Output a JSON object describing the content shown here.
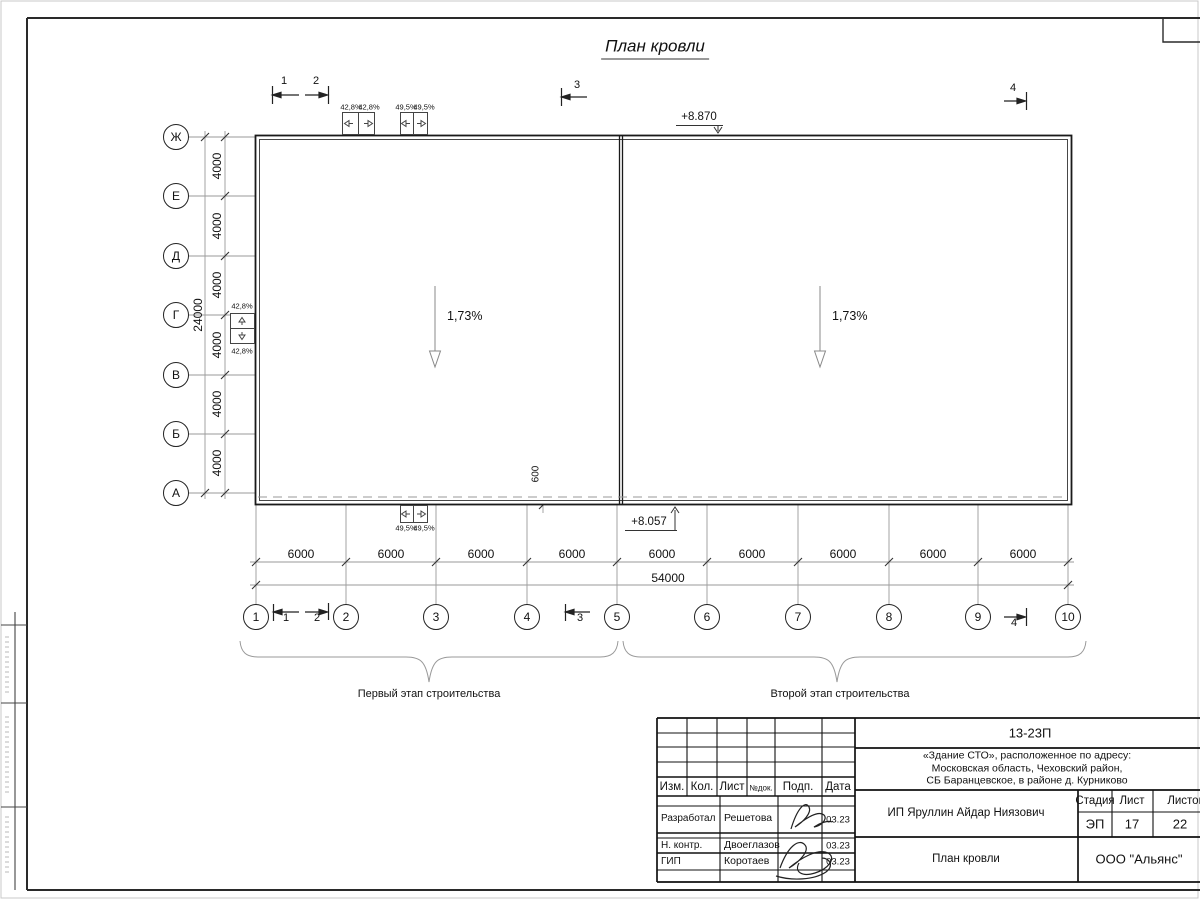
{
  "title": "План кровли",
  "grid": {
    "cols": [
      "1",
      "2",
      "3",
      "4",
      "5",
      "6",
      "7",
      "8",
      "9",
      "10"
    ],
    "rows": [
      "Ж",
      "Е",
      "Д",
      "Г",
      "В",
      "Б",
      "А"
    ],
    "bay_dims": [
      "6000",
      "6000",
      "6000",
      "6000",
      "6000",
      "6000",
      "6000",
      "6000",
      "6000"
    ],
    "row_dims": [
      "4000",
      "4000",
      "4000",
      "4000",
      "4000",
      "4000"
    ],
    "total_length": "54000",
    "total_depth": "24000"
  },
  "roof": {
    "slopes": [
      "1,73%",
      "1,73%"
    ],
    "elevation_top": "+8.870",
    "elevation_bottom": "+8.057",
    "overhang_dim": "600",
    "scupper_top_a": [
      "42,8%",
      "42,8%"
    ],
    "scupper_top_b": [
      "49,5%",
      "49,5%"
    ],
    "scupper_bottom": [
      "49,5%",
      "49,5%"
    ],
    "scupper_left": [
      "42,8%",
      "42,8%"
    ]
  },
  "sections": [
    "1",
    "2",
    "3",
    "4"
  ],
  "stages": {
    "first": "Первый этап строительства",
    "second": "Второй этап строительства"
  },
  "stamp": {
    "doc_number": "13-23П",
    "project_lines": [
      "«Здание СТО», расположенное по адресу:",
      "Московская область, Чеховский район,",
      "СБ Баранцевское, в районе д. Курниково"
    ],
    "columns": [
      "Изм.",
      "Кол.",
      "Лист",
      "№док.",
      "Подп.",
      "Дата"
    ],
    "signature_rows": [
      {
        "role": "Разработал",
        "name": "Решетова",
        "date": "03.23"
      },
      {
        "role": "Н. контр.",
        "name": "Двоеглазов",
        "date": "03.23"
      },
      {
        "role": "ГИП",
        "name": "Коротаев",
        "date": "03.23"
      }
    ],
    "client": "ИП Яруллин Айдар Ниязович",
    "sheet_name": "План кровли",
    "organization": "ООО \"Альянс\"",
    "stage_label": "Стадия",
    "sheet_label": "Лист",
    "sheets_label": "Листов",
    "stage": "ЭП",
    "sheet_number": "17",
    "sheets_total": "22"
  }
}
